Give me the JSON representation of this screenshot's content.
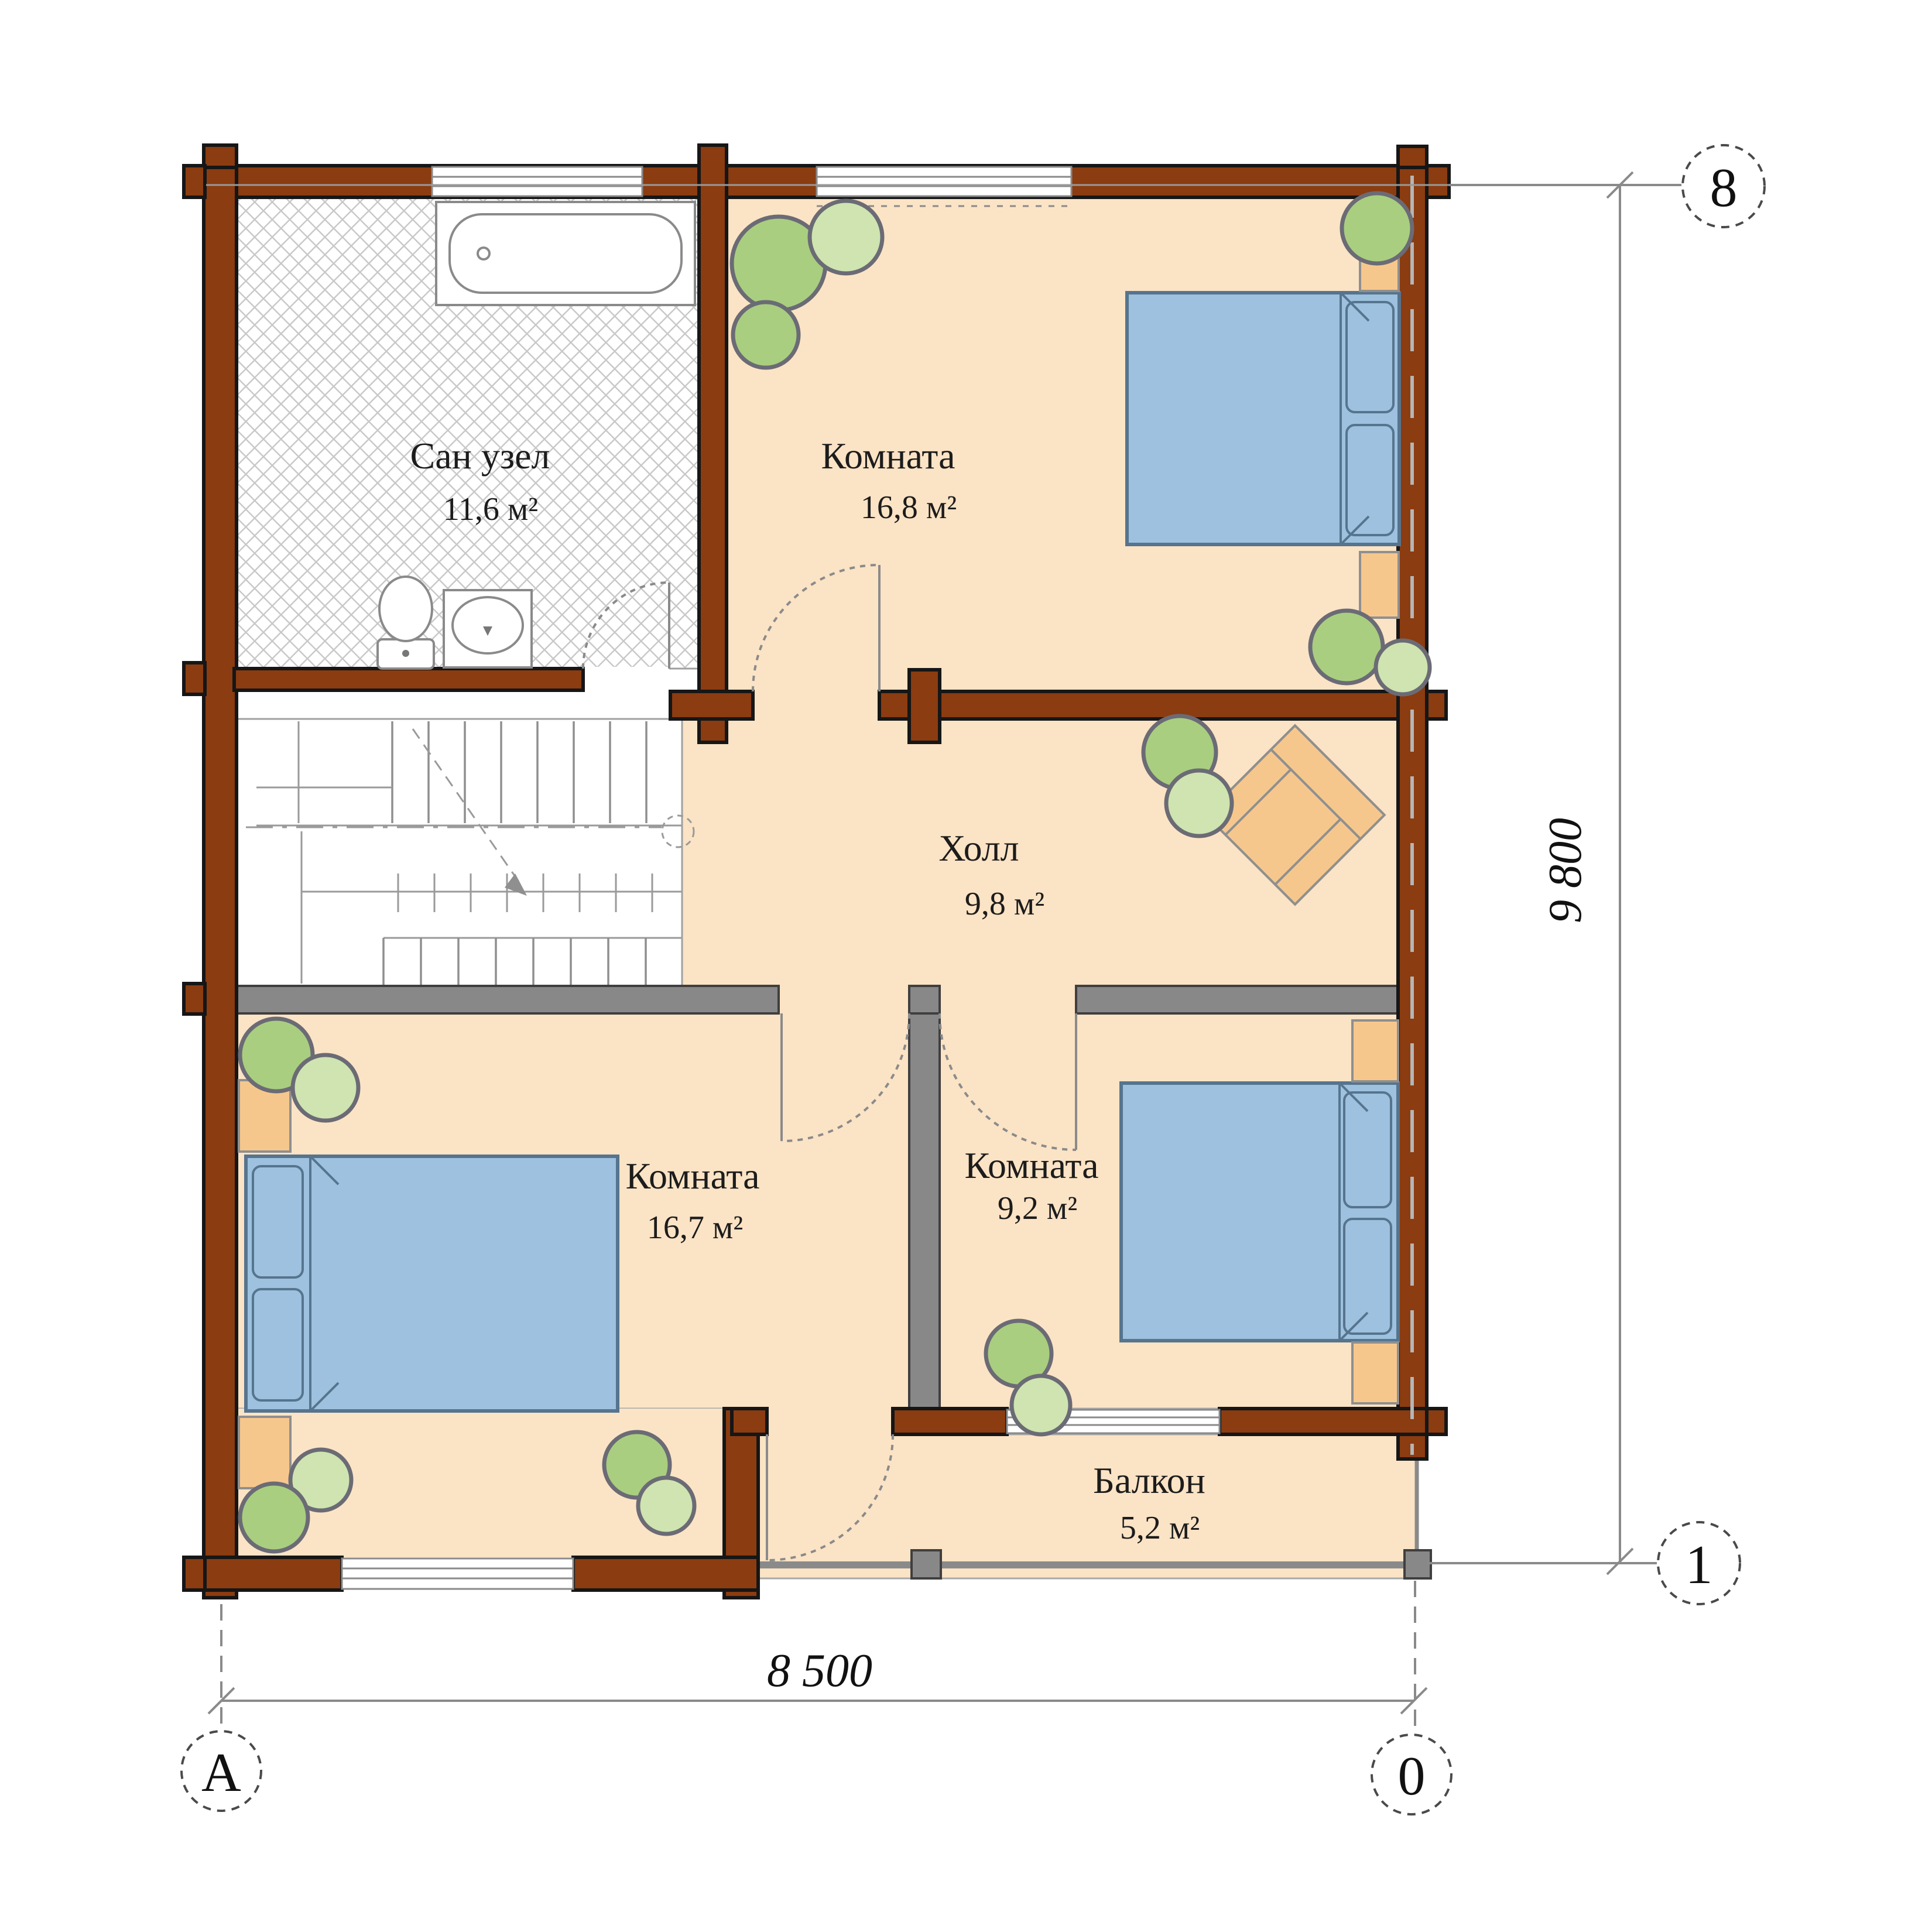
{
  "rooms": [
    {
      "name": "Сан узел",
      "area": "11,6 м²"
    },
    {
      "name": "Комната",
      "area": "16,8 м²"
    },
    {
      "name": "Холл",
      "area": "9,8 м²"
    },
    {
      "name": "Комната",
      "area": "16,7 м²"
    },
    {
      "name": "Комната",
      "area": "9,2 м²"
    },
    {
      "name": "Балкон",
      "area": "5,2 м²"
    }
  ],
  "dimensions": {
    "width_label": "8 500",
    "height_label": "9 800"
  },
  "axis_markers": {
    "top_right": "8",
    "right_bottom": "1",
    "bottom_left": "А",
    "bottom_right": "0"
  },
  "colors": {
    "wall": "#8B3C10",
    "interior_wall": "#888888",
    "floor": "#FBE3C5",
    "wood": "#F6C78C",
    "bed": "#9DC1DE",
    "plant_dark": "#A9CE80",
    "plant_light": "#CFE4B0",
    "hatch_line": "#C9C9C9",
    "line": "#8A8A8A",
    "text": "#1C1C1C"
  }
}
